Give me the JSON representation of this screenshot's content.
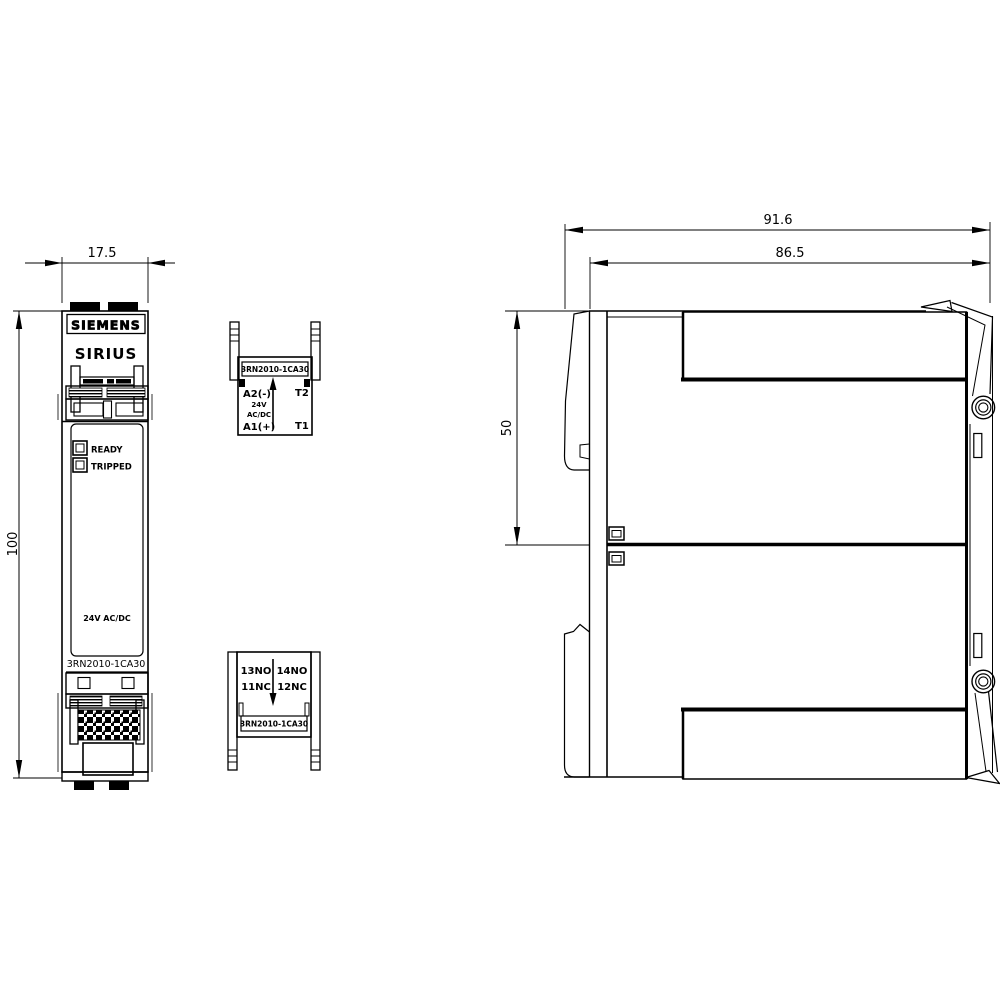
{
  "drawing": {
    "dims": {
      "front_width": "17.5",
      "front_height": "100",
      "side_total_width": "91.6",
      "side_body_width": "86.5",
      "side_upper_height": "50"
    },
    "front": {
      "brand": "SIEMENS",
      "series": "SIRIUS",
      "ready": "READY",
      "tripped": "TRIPPED",
      "voltage": "24V AC/DC",
      "part": "3RN2010-1CA30"
    },
    "top_block": {
      "part": "3RN2010-1CA30",
      "a2": "A2(-)",
      "v1": "24V",
      "v2": "AC/DC",
      "a1": "A1(+)",
      "t2": "T2",
      "t1": "T1"
    },
    "bottom_block": {
      "no13": "13NO",
      "no14": "14NO",
      "nc11": "11NC",
      "nc12": "12NC",
      "part": "3RN2010-1CA30"
    }
  }
}
